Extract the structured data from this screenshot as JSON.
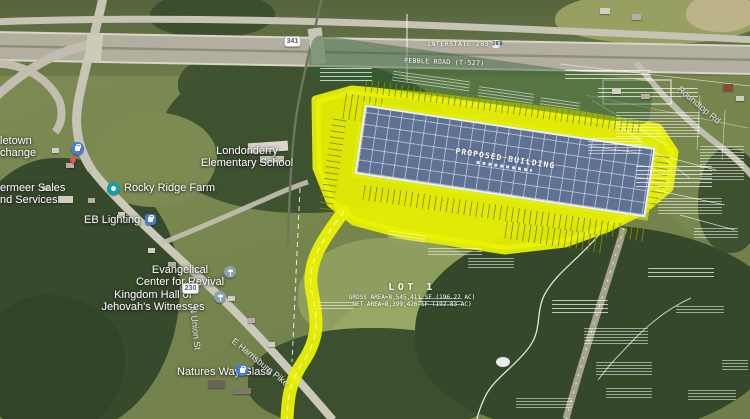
{
  "colors": {
    "site_highlight_yellow": "#e9f202",
    "building_roof_blue": "#5f7294",
    "plan_linework_white": "#ffffff"
  },
  "plan": {
    "proposed_building_label": "PROPOSED BUILDING",
    "interstate_label": "INTERSTATE 283",
    "interstate_shield": "283",
    "road_label": "PEBBLE ROAD (T-527)",
    "lot": {
      "title": "LOT 1",
      "gross": "GROSS AREA=8,545,411 SF (196.27 AC)",
      "net": "NET AREA=8,399,426 SF (192.83 AC)"
    }
  },
  "map": {
    "places": [
      {
        "id": "middletown-exchange-partial",
        "line1": "letown",
        "line2": "change"
      },
      {
        "id": "vermeer-sales-partial",
        "line1": "ermeer Sales",
        "line2": "nd Services"
      },
      {
        "id": "rocky-ridge-farm",
        "line1": "Rocky Ridge Farm",
        "line2": ""
      },
      {
        "id": "eb-lighting",
        "line1": "EB Lighting",
        "line2": ""
      },
      {
        "id": "londonderry-elementary",
        "line1": "Londonderry",
        "line2": "Elementary School"
      },
      {
        "id": "evangelical-center",
        "line1": "Evangelical",
        "line2": "Center for Revival"
      },
      {
        "id": "kingdom-hall",
        "line1": "Kingdom Hall of",
        "line2": "Jehovah's Witnesses"
      },
      {
        "id": "natures-way-glass",
        "line1": "Natures Way Glass",
        "line2": ""
      }
    ],
    "roads": [
      {
        "id": "roundtop-rd",
        "label": "Roundtop Rd"
      },
      {
        "id": "e-harrisburg-pike",
        "label": "E Harrisburg Pike"
      },
      {
        "id": "n-union-st",
        "label": "N Union St"
      }
    ],
    "shields": [
      {
        "id": "shield-341",
        "label": "341"
      },
      {
        "id": "shield-230",
        "label": "230"
      }
    ]
  }
}
